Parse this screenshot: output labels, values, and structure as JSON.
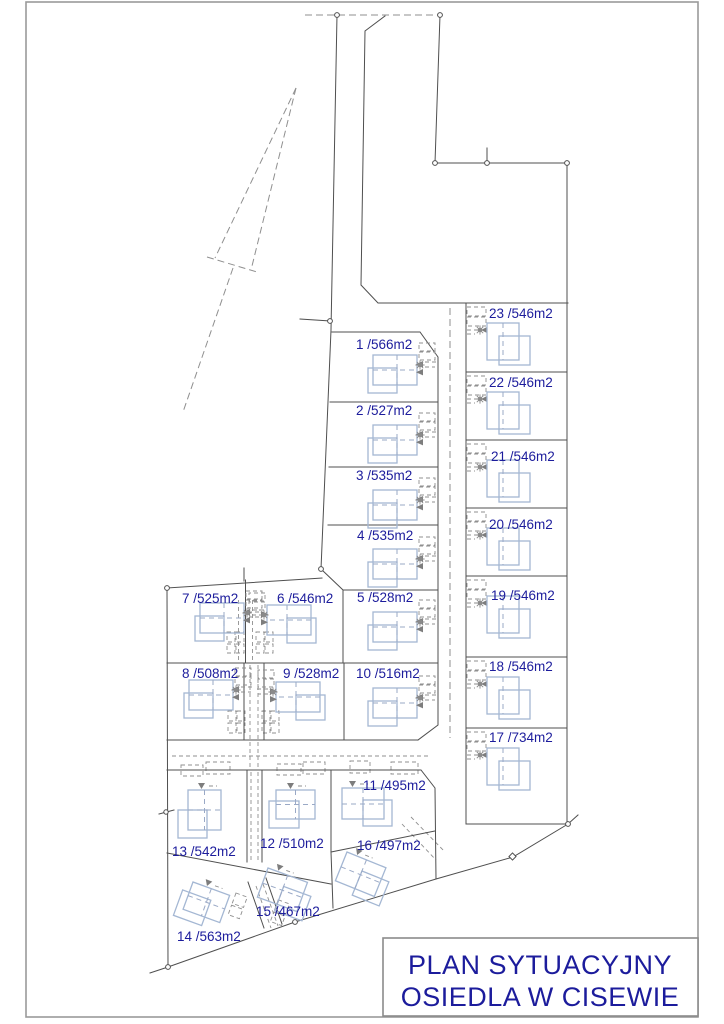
{
  "title_block": {
    "line1": "PLAN SYTUACYJNY",
    "line2": "OSIEDLA W CISEWIE"
  },
  "plots": [
    {
      "number": 1,
      "area_m2": 566,
      "label": "1 /566m2"
    },
    {
      "number": 2,
      "area_m2": 527,
      "label": "2 /527m2"
    },
    {
      "number": 3,
      "area_m2": 535,
      "label": "3 /535m2"
    },
    {
      "number": 4,
      "area_m2": 535,
      "label": "4 /535m2"
    },
    {
      "number": 5,
      "area_m2": 528,
      "label": "5 /528m2"
    },
    {
      "number": 6,
      "area_m2": 546,
      "label": "6 /546m2"
    },
    {
      "number": 7,
      "area_m2": 525,
      "label": "7 /525m2"
    },
    {
      "number": 8,
      "area_m2": 508,
      "label": "8 /508m2"
    },
    {
      "number": 9,
      "area_m2": 528,
      "label": "9 /528m2"
    },
    {
      "number": 10,
      "area_m2": 516,
      "label": "10 /516m2"
    },
    {
      "number": 11,
      "area_m2": 495,
      "label": "11 /495m2"
    },
    {
      "number": 12,
      "area_m2": 510,
      "label": "12 /510m2"
    },
    {
      "number": 13,
      "area_m2": 542,
      "label": "13 /542m2"
    },
    {
      "number": 14,
      "area_m2": 563,
      "label": "14 /563m2"
    },
    {
      "number": 15,
      "area_m2": 467,
      "label": "15 /467m2"
    },
    {
      "number": 16,
      "area_m2": 497,
      "label": "16 /497m2"
    },
    {
      "number": 17,
      "area_m2": 734,
      "label": "17 /734m2"
    },
    {
      "number": 18,
      "area_m2": 546,
      "label": "18 /546m2"
    },
    {
      "number": 19,
      "area_m2": 546,
      "label": "19 /546m2"
    },
    {
      "number": 20,
      "area_m2": 546,
      "label": "20 /546m2"
    },
    {
      "number": 21,
      "area_m2": 546,
      "label": "21 /546m2"
    },
    {
      "number": 22,
      "area_m2": 546,
      "label": "22 /546m2"
    },
    {
      "number": 23,
      "area_m2": 546,
      "label": "23 /546m2"
    }
  ],
  "colors": {
    "label_text": "#1c1c9c",
    "title_text": "#1c1c9c",
    "house_outline": "#a4b7d3",
    "house_dash": "#9aa9c6",
    "boundary_line": "#4f4f4f",
    "dashed_line": "#8f8f8f"
  }
}
